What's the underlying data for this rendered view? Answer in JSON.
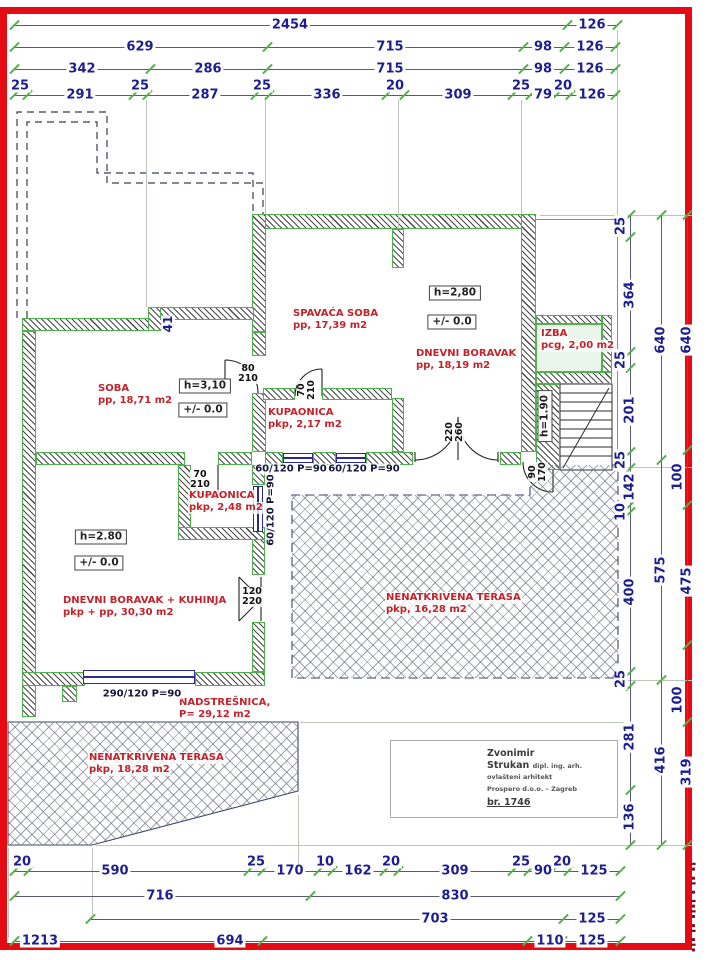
{
  "colors": {
    "frame_red": "#e50b15",
    "dim_blue": "#1d1d92",
    "room_red": "#c3232a",
    "wall_green": "#4ab44a",
    "tick_green": "#53b04a",
    "window_blue": "#2b2b96"
  },
  "dims": {
    "top": [
      {
        "y": 25,
        "x1": 14,
        "x2": 617,
        "labels": [
          {
            "x": 290,
            "t": "2454"
          },
          {
            "x": 592,
            "t": "126"
          }
        ],
        "ticks": [
          14,
          567,
          617
        ]
      },
      {
        "y": 47,
        "x1": 14,
        "x2": 617,
        "labels": [
          {
            "x": 140,
            "t": "629"
          },
          {
            "x": 390,
            "t": "715"
          },
          {
            "x": 543,
            "t": "98"
          },
          {
            "x": 590,
            "t": "126"
          }
        ],
        "ticks": [
          14,
          267,
          523,
          564,
          615
        ]
      },
      {
        "y": 69,
        "x1": 14,
        "x2": 617,
        "labels": [
          {
            "x": 82,
            "t": "342"
          },
          {
            "x": 208,
            "t": "286"
          },
          {
            "x": 390,
            "t": "715"
          },
          {
            "x": 543,
            "t": "98"
          },
          {
            "x": 590,
            "t": "126"
          }
        ],
        "ticks": [
          14,
          150,
          267,
          523,
          564,
          615
        ]
      },
      {
        "y": 95,
        "x1": 14,
        "x2": 617,
        "labels": [
          {
            "x": 20,
            "t": "25",
            "dy": -9
          },
          {
            "x": 80,
            "t": "291"
          },
          {
            "x": 140,
            "t": "25",
            "dy": -9
          },
          {
            "x": 205,
            "t": "287"
          },
          {
            "x": 262,
            "t": "25",
            "dy": -9
          },
          {
            "x": 327,
            "t": "336"
          },
          {
            "x": 395,
            "t": "20",
            "dy": -9
          },
          {
            "x": 458,
            "t": "309"
          },
          {
            "x": 521,
            "t": "25",
            "dy": -9
          },
          {
            "x": 543,
            "t": "79"
          },
          {
            "x": 563,
            "t": "20",
            "dy": -9
          },
          {
            "x": 592,
            "t": "126"
          }
        ],
        "ticks": [
          14,
          27,
          133,
          147,
          255,
          269,
          386,
          404,
          512,
          530,
          556,
          570,
          615
        ]
      }
    ],
    "bottom": [
      {
        "y": 871,
        "x1": 14,
        "x2": 620,
        "labels": [
          {
            "x": 22,
            "t": "20",
            "dy": -9
          },
          {
            "x": 115,
            "t": "590"
          },
          {
            "x": 256,
            "t": "25",
            "dy": -9
          },
          {
            "x": 290,
            "t": "170"
          },
          {
            "x": 325,
            "t": "10",
            "dy": -9
          },
          {
            "x": 358,
            "t": "162"
          },
          {
            "x": 391,
            "t": "20",
            "dy": -9
          },
          {
            "x": 455,
            "t": "309"
          },
          {
            "x": 521,
            "t": "25",
            "dy": -9
          },
          {
            "x": 543,
            "t": "90"
          },
          {
            "x": 562,
            "t": "20",
            "dy": -9
          },
          {
            "x": 594,
            "t": "125"
          }
        ],
        "ticks": [
          14,
          28,
          248,
          262,
          318,
          332,
          384,
          398,
          512,
          528,
          552,
          568,
          620
        ]
      },
      {
        "y": 896,
        "x1": 14,
        "x2": 620,
        "labels": [
          {
            "x": 160,
            "t": "716"
          },
          {
            "x": 455,
            "t": "830"
          }
        ],
        "ticks": [
          14,
          310,
          620
        ]
      },
      {
        "y": 919,
        "x1": 90,
        "x2": 620,
        "labels": [
          {
            "x": 435,
            "t": "703"
          },
          {
            "x": 592,
            "t": "125"
          }
        ],
        "ticks": [
          90,
          563,
          620
        ]
      },
      {
        "y": 941,
        "x1": 14,
        "x2": 620,
        "labels": [
          {
            "x": 40,
            "t": "1213"
          },
          {
            "x": 230,
            "t": "694"
          },
          {
            "x": 550,
            "t": "110"
          },
          {
            "x": 592,
            "t": "125"
          }
        ],
        "ticks": [
          14,
          262,
          527,
          562,
          620
        ]
      }
    ],
    "right": [
      {
        "x": 630,
        "y1": 215,
        "y2": 845,
        "labels": [
          {
            "y": 226,
            "t": "25",
            "dx": -9
          },
          {
            "y": 295,
            "t": "364"
          },
          {
            "y": 360,
            "t": "25",
            "dx": -9
          },
          {
            "y": 410,
            "t": "201"
          },
          {
            "y": 460,
            "t": "25",
            "dx": -9
          },
          {
            "y": 487,
            "t": "142"
          },
          {
            "y": 512,
            "t": "10",
            "dx": -9
          },
          {
            "y": 592,
            "t": "400"
          },
          {
            "y": 679,
            "t": "25",
            "dx": -9
          },
          {
            "y": 737,
            "t": "281"
          },
          {
            "y": 817,
            "t": "136"
          }
        ],
        "ticks": [
          215,
          237,
          352,
          368,
          452,
          468,
          505,
          512,
          672,
          686,
          790,
          845
        ]
      },
      {
        "x": 661,
        "y1": 215,
        "y2": 845,
        "labels": [
          {
            "y": 340,
            "t": "640"
          },
          {
            "y": 570,
            "t": "575"
          },
          {
            "y": 760,
            "t": "416"
          }
        ],
        "ticks": [
          215,
          460,
          680,
          845
        ]
      },
      {
        "x": 687,
        "y1": 215,
        "y2": 845,
        "labels": [
          {
            "y": 340,
            "t": "640"
          },
          {
            "y": 477,
            "t": "100",
            "dx": -9
          },
          {
            "y": 581,
            "t": "475"
          },
          {
            "y": 700,
            "t": "100",
            "dx": -9
          },
          {
            "y": 772,
            "t": "319"
          }
        ],
        "ticks": [
          215,
          450,
          505,
          645,
          722,
          845
        ]
      }
    ]
  },
  "rooms": [
    {
      "x": 97,
      "y": 383,
      "lines": [
        "SOBA",
        "pp, 18,71 m2"
      ]
    },
    {
      "x": 292,
      "y": 308,
      "lines": [
        "SPAVAĆA SOBA",
        "pp, 17,39 m2"
      ]
    },
    {
      "x": 415,
      "y": 348,
      "lines": [
        "DNEVNI BORAVAK",
        "pp, 18,19 m2"
      ]
    },
    {
      "x": 540,
      "y": 328,
      "lines": [
        "IZBA",
        "pcg, 2,00 m2"
      ]
    },
    {
      "x": 267,
      "y": 407,
      "lines": [
        "KUPAONICA",
        "pkp, 2,17 m2"
      ]
    },
    {
      "x": 188,
      "y": 490,
      "lines": [
        "KUPAONICA",
        "pkp, 2,48 m2"
      ]
    },
    {
      "x": 62,
      "y": 595,
      "lines": [
        "DNEVNI BORAVAK + KUHINJA",
        "pkp + pp, 30,30 m2"
      ]
    },
    {
      "x": 385,
      "y": 592,
      "lines": [
        "NENATKRIVENA TERASA",
        "pkp, 16,28 m2"
      ]
    },
    {
      "x": 178,
      "y": 697,
      "lines": [
        "NADSTREŠNICA,",
        "P= 29,12 m2"
      ]
    },
    {
      "x": 88,
      "y": 752,
      "lines": [
        "NENATKRIVENA TERASA",
        "pkp, 18,28 m2"
      ]
    }
  ],
  "boxes": [
    {
      "x": 205,
      "y": 386,
      "t": "h=3,10"
    },
    {
      "x": 203,
      "y": 410,
      "t": "+/- 0.0"
    },
    {
      "x": 455,
      "y": 293,
      "t": "h=2,80"
    },
    {
      "x": 452,
      "y": 322,
      "t": "+/- 0.0"
    },
    {
      "x": 101,
      "y": 537,
      "t": "h=2.80"
    },
    {
      "x": 99,
      "y": 563,
      "t": "+/- 0.0"
    },
    {
      "x": 545,
      "y": 416,
      "t": "h=1.90",
      "rot": 1
    }
  ],
  "door_labels": [
    {
      "x": 248,
      "y": 374,
      "l": [
        "80",
        "210"
      ]
    },
    {
      "x": 307,
      "y": 390,
      "l": [
        "70",
        "210"
      ],
      "rot": 1
    },
    {
      "x": 200,
      "y": 480,
      "l": [
        "70",
        "210"
      ]
    },
    {
      "x": 252,
      "y": 597,
      "l": [
        "120",
        "220"
      ]
    },
    {
      "x": 455,
      "y": 432,
      "l": [
        "220",
        "260"
      ],
      "rot": 1
    },
    {
      "x": 538,
      "y": 472,
      "l": [
        "90",
        "170"
      ],
      "rot": 1
    }
  ],
  "win_labels": [
    {
      "x": 291,
      "y": 469,
      "t": "60/120 P=90"
    },
    {
      "x": 364,
      "y": 469,
      "t": "60/120 P=90"
    },
    {
      "x": 271,
      "y": 510,
      "t": "60/120 P=90",
      "rot": 1
    },
    {
      "x": 142,
      "y": 694,
      "t": "290/120 P=90"
    },
    {
      "x": 168,
      "y": 324,
      "t": "41",
      "rot": 1,
      "dim": 1
    }
  ],
  "walls": [
    {
      "x": 263,
      "y": 214,
      "w": 273,
      "h": 15
    },
    {
      "x": 252,
      "y": 214,
      "w": 14,
      "h": 118
    },
    {
      "x": 252,
      "y": 332,
      "w": 14,
      "h": 24
    },
    {
      "x": 252,
      "y": 393,
      "w": 14,
      "h": 59
    },
    {
      "x": 521,
      "y": 214,
      "w": 15,
      "h": 238
    },
    {
      "x": 392,
      "y": 229,
      "w": 12,
      "h": 39
    },
    {
      "x": 392,
      "y": 398,
      "w": 12,
      "h": 54
    },
    {
      "x": 263,
      "y": 388,
      "w": 32,
      "h": 12
    },
    {
      "x": 322,
      "y": 388,
      "w": 70,
      "h": 12
    },
    {
      "x": 22,
      "y": 318,
      "w": 128,
      "h": 13
    },
    {
      "x": 148,
      "y": 307,
      "w": 14,
      "h": 24
    },
    {
      "x": 160,
      "y": 307,
      "w": 94,
      "h": 13
    },
    {
      "x": 22,
      "y": 331,
      "w": 14,
      "h": 386
    },
    {
      "x": 36,
      "y": 452,
      "w": 149,
      "h": 13
    },
    {
      "x": 218,
      "y": 452,
      "w": 34,
      "h": 13
    },
    {
      "x": 252,
      "y": 465,
      "w": 13,
      "h": 20
    },
    {
      "x": 252,
      "y": 532,
      "w": 13,
      "h": 43
    },
    {
      "x": 252,
      "y": 622,
      "w": 13,
      "h": 50
    },
    {
      "x": 178,
      "y": 465,
      "w": 13,
      "h": 75
    },
    {
      "x": 178,
      "y": 527,
      "w": 87,
      "h": 13
    },
    {
      "x": 22,
      "y": 672,
      "w": 63,
      "h": 14
    },
    {
      "x": 195,
      "y": 672,
      "w": 70,
      "h": 14
    },
    {
      "x": 62,
      "y": 686,
      "w": 15,
      "h": 16
    },
    {
      "x": 265,
      "y": 452,
      "w": 18,
      "h": 13
    },
    {
      "x": 313,
      "y": 452,
      "w": 23,
      "h": 13
    },
    {
      "x": 366,
      "y": 452,
      "w": 47,
      "h": 13
    },
    {
      "x": 500,
      "y": 452,
      "w": 21,
      "h": 13
    },
    {
      "x": 536,
      "y": 315,
      "w": 66,
      "h": 9
    },
    {
      "x": 602,
      "y": 315,
      "w": 10,
      "h": 57
    },
    {
      "x": 536,
      "y": 372,
      "w": 76,
      "h": 12
    },
    {
      "x": 536,
      "y": 384,
      "w": 24,
      "h": 86
    }
  ],
  "windows": [
    {
      "x": 283,
      "y": 453,
      "w": 30,
      "h": 10
    },
    {
      "x": 336,
      "y": 453,
      "w": 30,
      "h": 10
    },
    {
      "x": 253,
      "y": 486,
      "w": 10,
      "h": 46,
      "v": 1
    },
    {
      "x": 83,
      "y": 670,
      "w": 112,
      "h": 14
    }
  ],
  "terraces": [
    {
      "x": 292,
      "y": 465,
      "w": 326,
      "h": 213,
      "clip": "polygon(0 30px,238px 30px,238px 0,326px 0,326px 213px,0 213px)"
    },
    {
      "x": 8,
      "y": 722,
      "w": 290,
      "h": 123,
      "clip": "polygon(0 0,290px 0,290px 69px,84px 123px,0 123px)"
    }
  ],
  "izba": {
    "x": 536,
    "y": 324,
    "w": 66,
    "h": 48
  },
  "green_lines": [
    {
      "x": 536,
      "y": 219,
      "w": 82,
      "h": 1
    },
    {
      "x": 617,
      "y": 219,
      "w": 1,
      "h": 248
    }
  ],
  "ext_v": [
    {
      "x": 146,
      "y1": 100,
      "y2": 307
    },
    {
      "x": 265,
      "y1": 100,
      "y2": 214
    },
    {
      "x": 398,
      "y1": 100,
      "y2": 229
    },
    {
      "x": 521,
      "y1": 100,
      "y2": 214
    },
    {
      "x": 617,
      "y1": 30,
      "y2": 219
    },
    {
      "x": 8,
      "y1": 848,
      "y2": 938
    },
    {
      "x": 92,
      "y1": 848,
      "y2": 915
    },
    {
      "x": 298,
      "y1": 795,
      "y2": 868
    }
  ],
  "ext_h": [
    {
      "y": 215,
      "x1": 540,
      "x2": 692
    },
    {
      "y": 467,
      "x1": 620,
      "x2": 692
    },
    {
      "y": 680,
      "x1": 620,
      "x2": 692
    },
    {
      "y": 722,
      "x1": 300,
      "x2": 625
    },
    {
      "y": 845,
      "x1": 96,
      "x2": 692
    }
  ],
  "signature": {
    "name_first": "Zvonimir",
    "name_last": "Strukan",
    "title_suffix": "dipl. ing. arh.",
    "line3": "ovlašteni arhitekt",
    "line4": "Prospero d.o.o. – Zagreb",
    "line5": "br. 1746"
  },
  "stamp": {
    "text": "▪▮▪ ▮▪ ▪▮▪▮ ▪ ▮▪ ▪▮"
  }
}
